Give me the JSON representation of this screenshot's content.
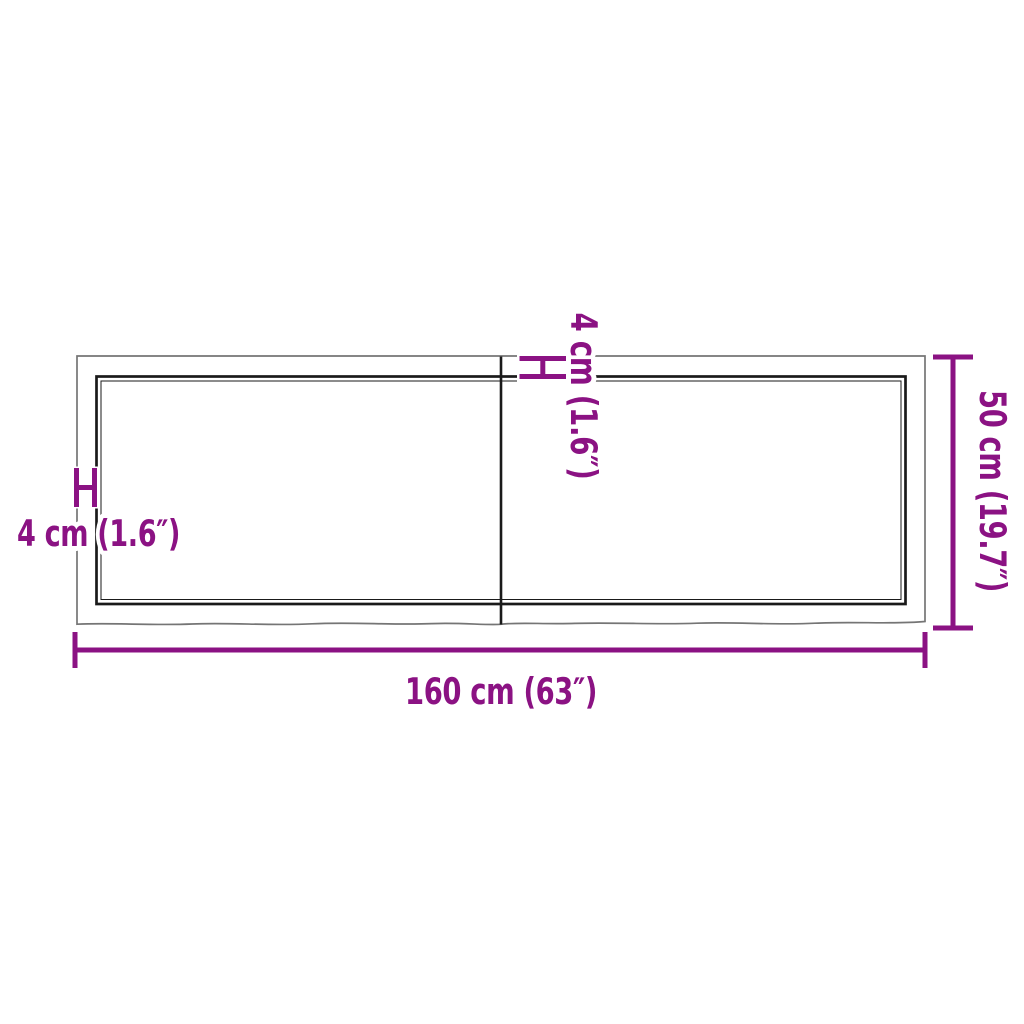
{
  "diagram": {
    "view": "top-view board dimension drawing",
    "labels": {
      "width": "160 cm (63″)",
      "depth": "50 cm (19.7″)",
      "edge_thickness_left": "4 cm (1.6″)",
      "edge_thickness_top": "4 cm (1.6″)"
    },
    "dimensions": {
      "width_cm": 160,
      "width_in": 63,
      "depth_cm": 50,
      "depth_in": 19.7,
      "edge_thickness_cm": 4,
      "edge_thickness_in": 1.6
    },
    "colors": {
      "accent": "#8B1283",
      "edge_gray": "#757575",
      "edge_black": "#1a1a1a",
      "background": "#ffffff"
    }
  }
}
